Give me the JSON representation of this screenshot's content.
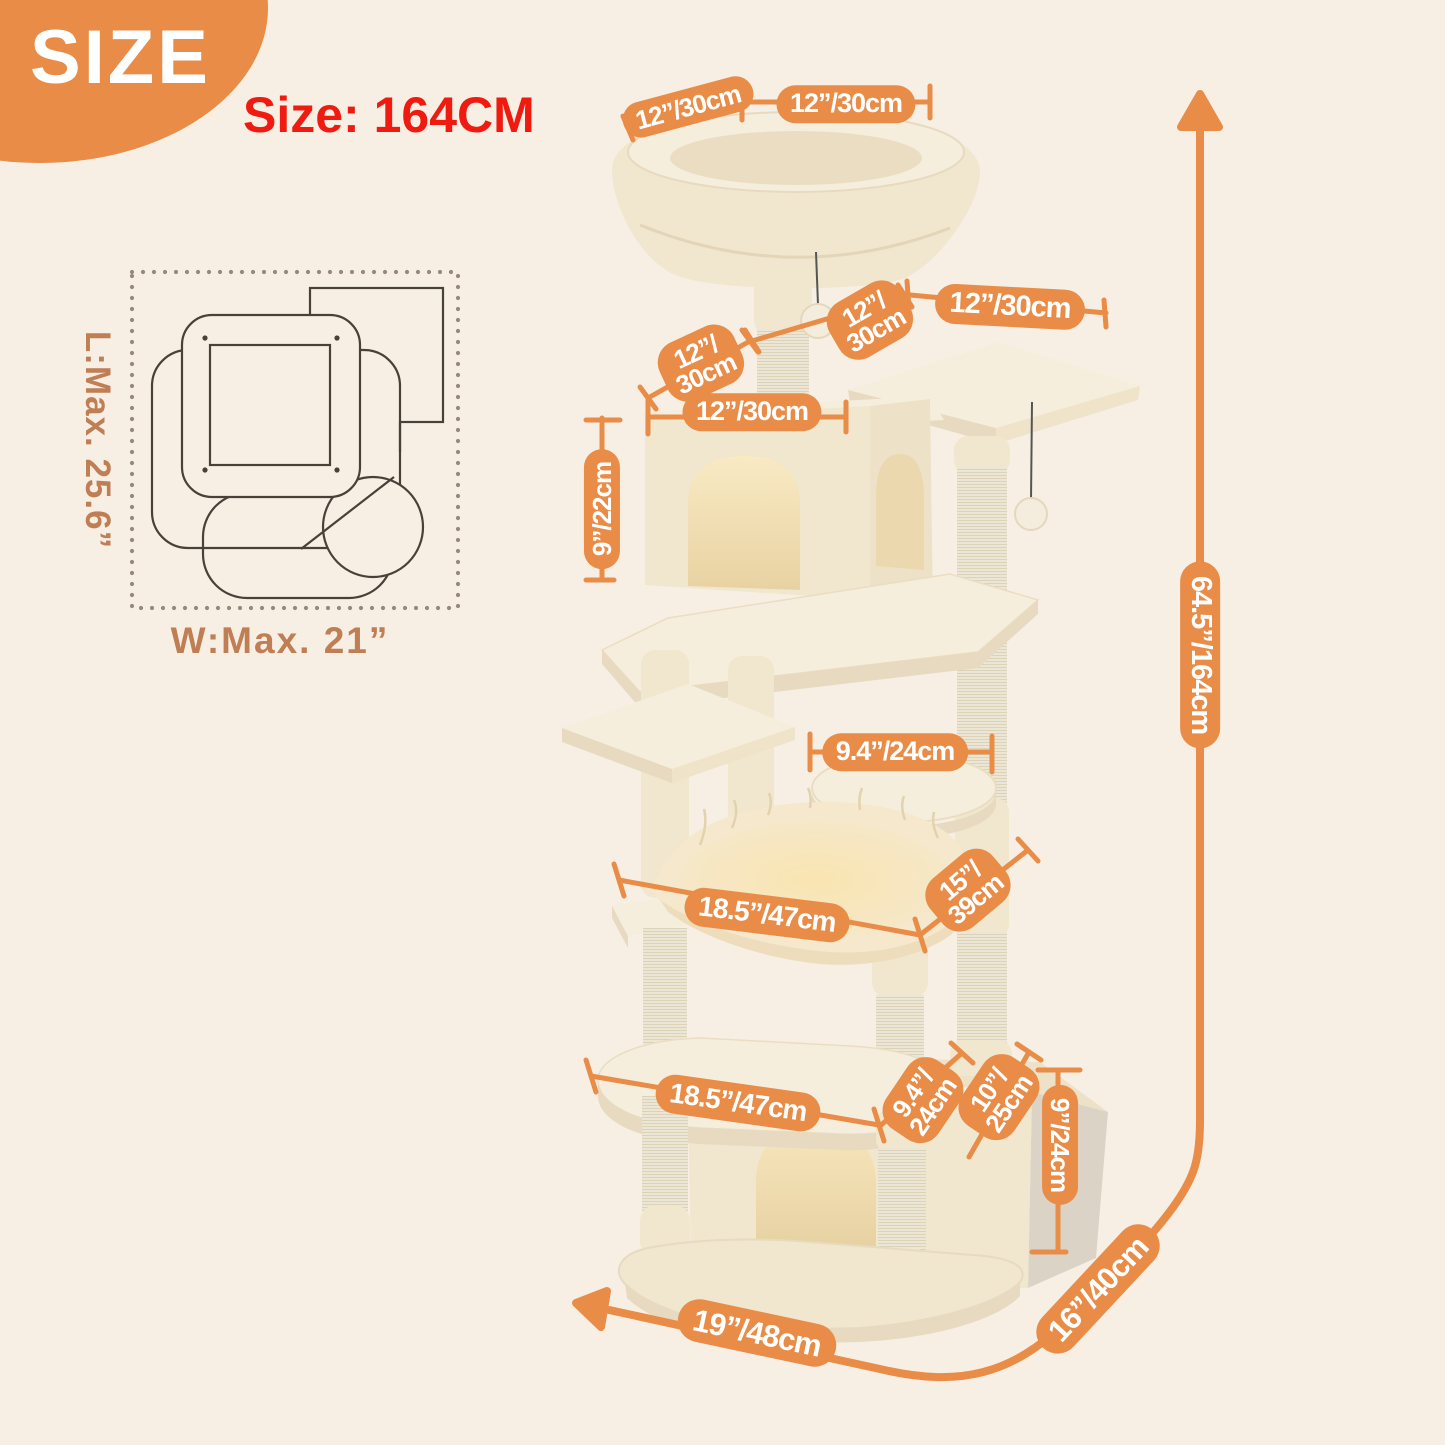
{
  "badge": {
    "label": "SIZE"
  },
  "title": {
    "text": "Size: 164CM"
  },
  "palette": {
    "background": "#F7EFE3",
    "accent_orange": "#E88C47",
    "title_red": "#EF1A10",
    "footprint_text_tan": "#C07E55",
    "product_cream": "#F3E9D4"
  },
  "footprint": {
    "length_label": "L:Max. 25.6”",
    "width_label": "W:Max. 21”"
  },
  "dimensions": [
    {
      "id": "top-basket-width-left",
      "text": "12”/30cm"
    },
    {
      "id": "top-basket-width-top",
      "text": "12”/30cm"
    },
    {
      "id": "upper-post-depth",
      "text": "12”/\n30cm"
    },
    {
      "id": "top-perch-width",
      "text": "12”/30cm"
    },
    {
      "id": "condo-depth",
      "text": "12”/\n30cm"
    },
    {
      "id": "condo-width",
      "text": "12”/30cm"
    },
    {
      "id": "condo-height",
      "text": "9”/22cm"
    },
    {
      "id": "round-perch-width",
      "text": "9.4”/24cm"
    },
    {
      "id": "hammock-width",
      "text": "18.5”/47cm"
    },
    {
      "id": "hammock-depth",
      "text": "15”/\n39cm"
    },
    {
      "id": "lower-platform-width",
      "text": "18.5”/47cm"
    },
    {
      "id": "lower-platform-depth",
      "text": "9.4”/\n24cm"
    },
    {
      "id": "base-house-width",
      "text": "10”/\n25cm"
    },
    {
      "id": "base-house-height",
      "text": "9”/24cm"
    },
    {
      "id": "base-width",
      "text": "19”/48cm"
    },
    {
      "id": "base-depth",
      "text": "16”/40cm"
    },
    {
      "id": "total-height",
      "text": "64.5”/164cm"
    }
  ]
}
